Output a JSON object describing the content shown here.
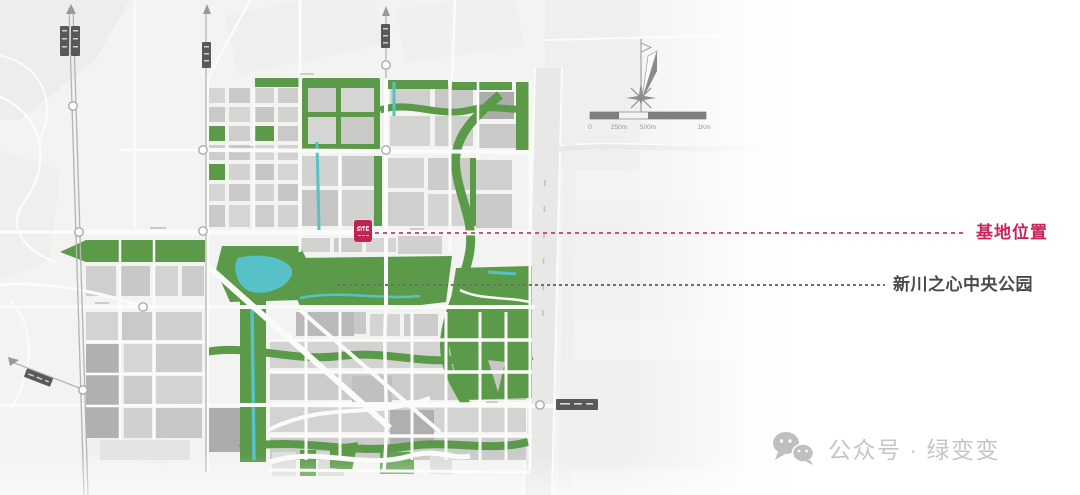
{
  "map": {
    "site_marker": {
      "label": "SITE",
      "color": "#C22350"
    },
    "annotations": [
      {
        "id": "site-location",
        "label": "基地位置",
        "color": "#C9255C",
        "line_style": "dashed"
      },
      {
        "id": "central-park",
        "label": "新川之心中央公园",
        "color": "#4A4A4A",
        "line_style": "dashed"
      }
    ],
    "compass": {
      "type": "north-arrow"
    },
    "scale_bar": {
      "labels": [
        "0",
        "250m",
        "500m",
        "1Km"
      ]
    },
    "legend_colors": {
      "park_green": "#5B9A49",
      "water_cyan": "#56C2C8",
      "block_gray": "#CFCFCD",
      "road_white": "#FBFBFA",
      "accent_pink": "#C9255C"
    }
  },
  "watermark": {
    "icon": "wechat-icon",
    "text": "公众号 · 绿变变"
  }
}
